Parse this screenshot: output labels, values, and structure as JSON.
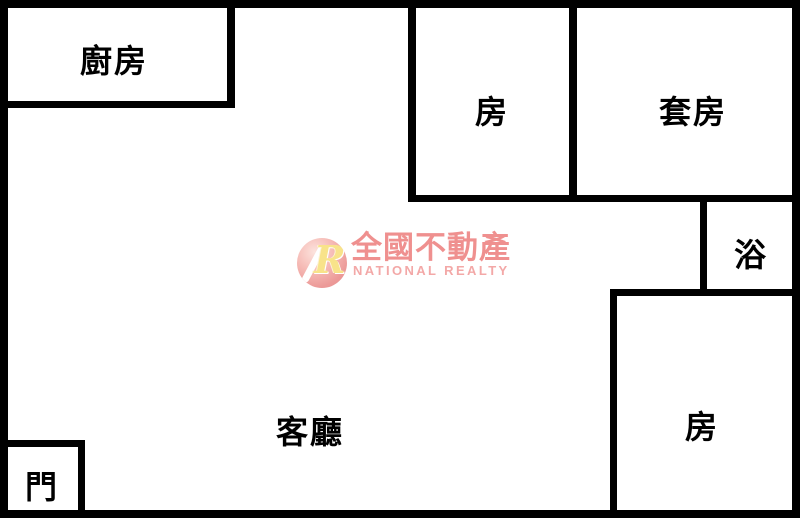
{
  "floor_plan": {
    "rooms": {
      "kitchen": "廚房",
      "bedroom_top": "房",
      "suite": "套房",
      "bath": "浴",
      "bedroom_bottom": "房",
      "living_room": "客廳",
      "door": "門"
    },
    "logo": {
      "monogram": "R",
      "brand": "全國不動產",
      "subtitle": "NATIONAL REALTY",
      "colors": {
        "brand_text": "#ef908f",
        "subtitle_text": "#f3a8a7",
        "circle": "#ec9a98",
        "monogram_fill": "#f8e38a"
      }
    },
    "colors": {
      "wall": "#000000",
      "background": "#ffffff",
      "label_text": "#000000"
    }
  }
}
